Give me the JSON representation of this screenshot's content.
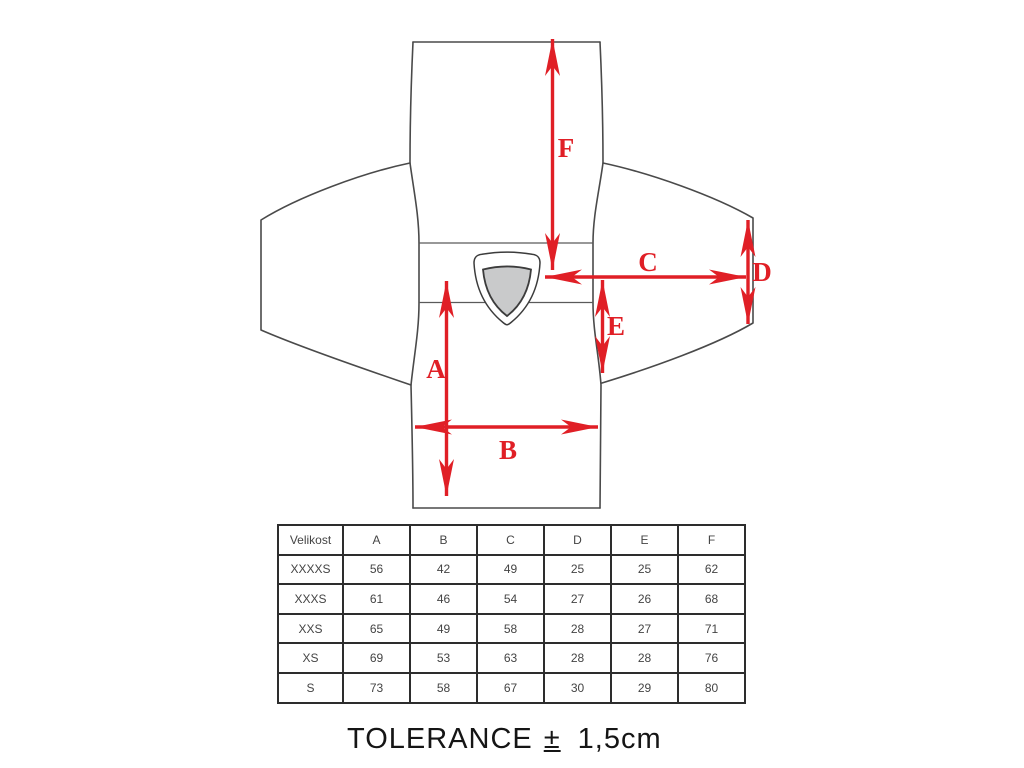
{
  "diagram": {
    "dimension_labels": {
      "A": "A",
      "B": "B",
      "C": "C",
      "D": "D",
      "E": "E",
      "F": "F"
    },
    "arrow_color": "#e01f26",
    "outline_color": "#4a4a4a",
    "emblem_fill": "#c9cacb"
  },
  "size_table": {
    "header": [
      "Velikost",
      "A",
      "B",
      "C",
      "D",
      "E",
      "F"
    ],
    "rows": [
      [
        "XXXXS",
        "56",
        "42",
        "49",
        "25",
        "25",
        "62"
      ],
      [
        "XXXS",
        "61",
        "46",
        "54",
        "27",
        "26",
        "68"
      ],
      [
        "XXS",
        "65",
        "49",
        "58",
        "28",
        "27",
        "71"
      ],
      [
        "XS",
        "69",
        "53",
        "63",
        "28",
        "28",
        "76"
      ],
      [
        "S",
        "73",
        "58",
        "67",
        "30",
        "29",
        "80"
      ]
    ]
  },
  "tolerance": {
    "label": "TOLERANCE",
    "symbol": "±",
    "value": "1,5cm"
  }
}
